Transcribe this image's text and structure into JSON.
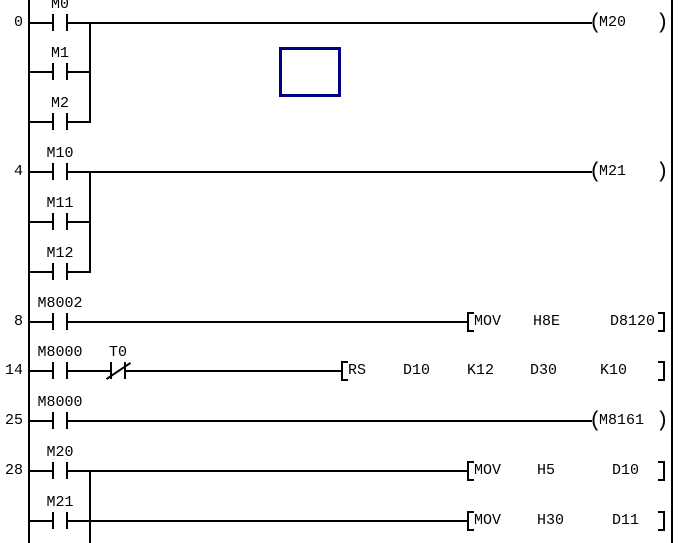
{
  "colors": {
    "background": "#ffffff",
    "line": "#000000",
    "text": "#000000",
    "cursor": "#000080"
  },
  "ladder": {
    "width": 683,
    "height": 543,
    "left_rail_x": 28,
    "right_rail_x": 671,
    "coil": {
      "open_x": 589,
      "label_x": 599,
      "close_x": 656
    },
    "instr_close_x": 658,
    "cursor_box": {
      "x": 279,
      "y": 47,
      "w": 62,
      "h": 50
    },
    "symbols": {
      "coil_open": "(",
      "coil_close": ")"
    },
    "branches": [
      {
        "x": 89,
        "y1": 22,
        "y2": 123
      },
      {
        "x": 89,
        "y1": 171,
        "y2": 273
      },
      {
        "x": 89,
        "y1": 470,
        "y2": 543
      }
    ],
    "rows": [
      {
        "y": 23,
        "step": "0",
        "contacts": [
          {
            "label": "M0",
            "cx": 60,
            "nc": false
          }
        ],
        "terminal": {
          "type": "coil",
          "label": "M20"
        }
      },
      {
        "y": 72,
        "contacts": [
          {
            "label": "M1",
            "cx": 60,
            "nc": false
          }
        ],
        "terminal": {
          "type": "branch",
          "x": 89
        }
      },
      {
        "y": 122,
        "contacts": [
          {
            "label": "M2",
            "cx": 60,
            "nc": false
          }
        ],
        "terminal": {
          "type": "branch",
          "x": 89
        }
      },
      {
        "y": 172,
        "step": "4",
        "contacts": [
          {
            "label": "M10",
            "cx": 60,
            "nc": false
          }
        ],
        "terminal": {
          "type": "coil",
          "label": "M21"
        }
      },
      {
        "y": 222,
        "contacts": [
          {
            "label": "M11",
            "cx": 60,
            "nc": false
          }
        ],
        "terminal": {
          "type": "branch",
          "x": 89
        }
      },
      {
        "y": 272,
        "contacts": [
          {
            "label": "M12",
            "cx": 60,
            "nc": false
          }
        ],
        "terminal": {
          "type": "branch",
          "x": 89
        }
      },
      {
        "y": 322,
        "step": "8",
        "contacts": [
          {
            "label": "M8002",
            "cx": 60,
            "nc": false
          }
        ],
        "terminal": {
          "type": "instruction",
          "x": 467,
          "parts": [
            {
              "text": "MOV",
              "x": 474
            },
            {
              "text": "H8E",
              "x": 533
            },
            {
              "text": "D8120",
              "x": 610
            }
          ]
        }
      },
      {
        "y": 371,
        "step": "14",
        "contacts": [
          {
            "label": "M8000",
            "cx": 60,
            "nc": false
          },
          {
            "label": "T0",
            "cx": 118,
            "nc": true
          }
        ],
        "terminal": {
          "type": "instruction",
          "x": 341,
          "parts": [
            {
              "text": "RS",
              "x": 348
            },
            {
              "text": "D10",
              "x": 403
            },
            {
              "text": "K12",
              "x": 467
            },
            {
              "text": "D30",
              "x": 530
            },
            {
              "text": "K10",
              "x": 600
            }
          ]
        }
      },
      {
        "y": 421,
        "step": "25",
        "contacts": [
          {
            "label": "M8000",
            "cx": 60,
            "nc": false
          }
        ],
        "terminal": {
          "type": "coil",
          "label": "M8161"
        }
      },
      {
        "y": 471,
        "step": "28",
        "contacts": [
          {
            "label": "M20",
            "cx": 60,
            "nc": false
          }
        ],
        "terminal": {
          "type": "instruction",
          "x": 467,
          "parts": [
            {
              "text": "MOV",
              "x": 474
            },
            {
              "text": "H5",
              "x": 537
            },
            {
              "text": "D10",
              "x": 612
            }
          ]
        }
      },
      {
        "y": 521,
        "contacts": [
          {
            "label": "M21",
            "cx": 60,
            "nc": false
          }
        ],
        "terminal": {
          "type": "instruction",
          "x": 467,
          "parts": [
            {
              "text": "MOV",
              "x": 474
            },
            {
              "text": "H30",
              "x": 537
            },
            {
              "text": "D11",
              "x": 612
            }
          ]
        }
      }
    ]
  }
}
